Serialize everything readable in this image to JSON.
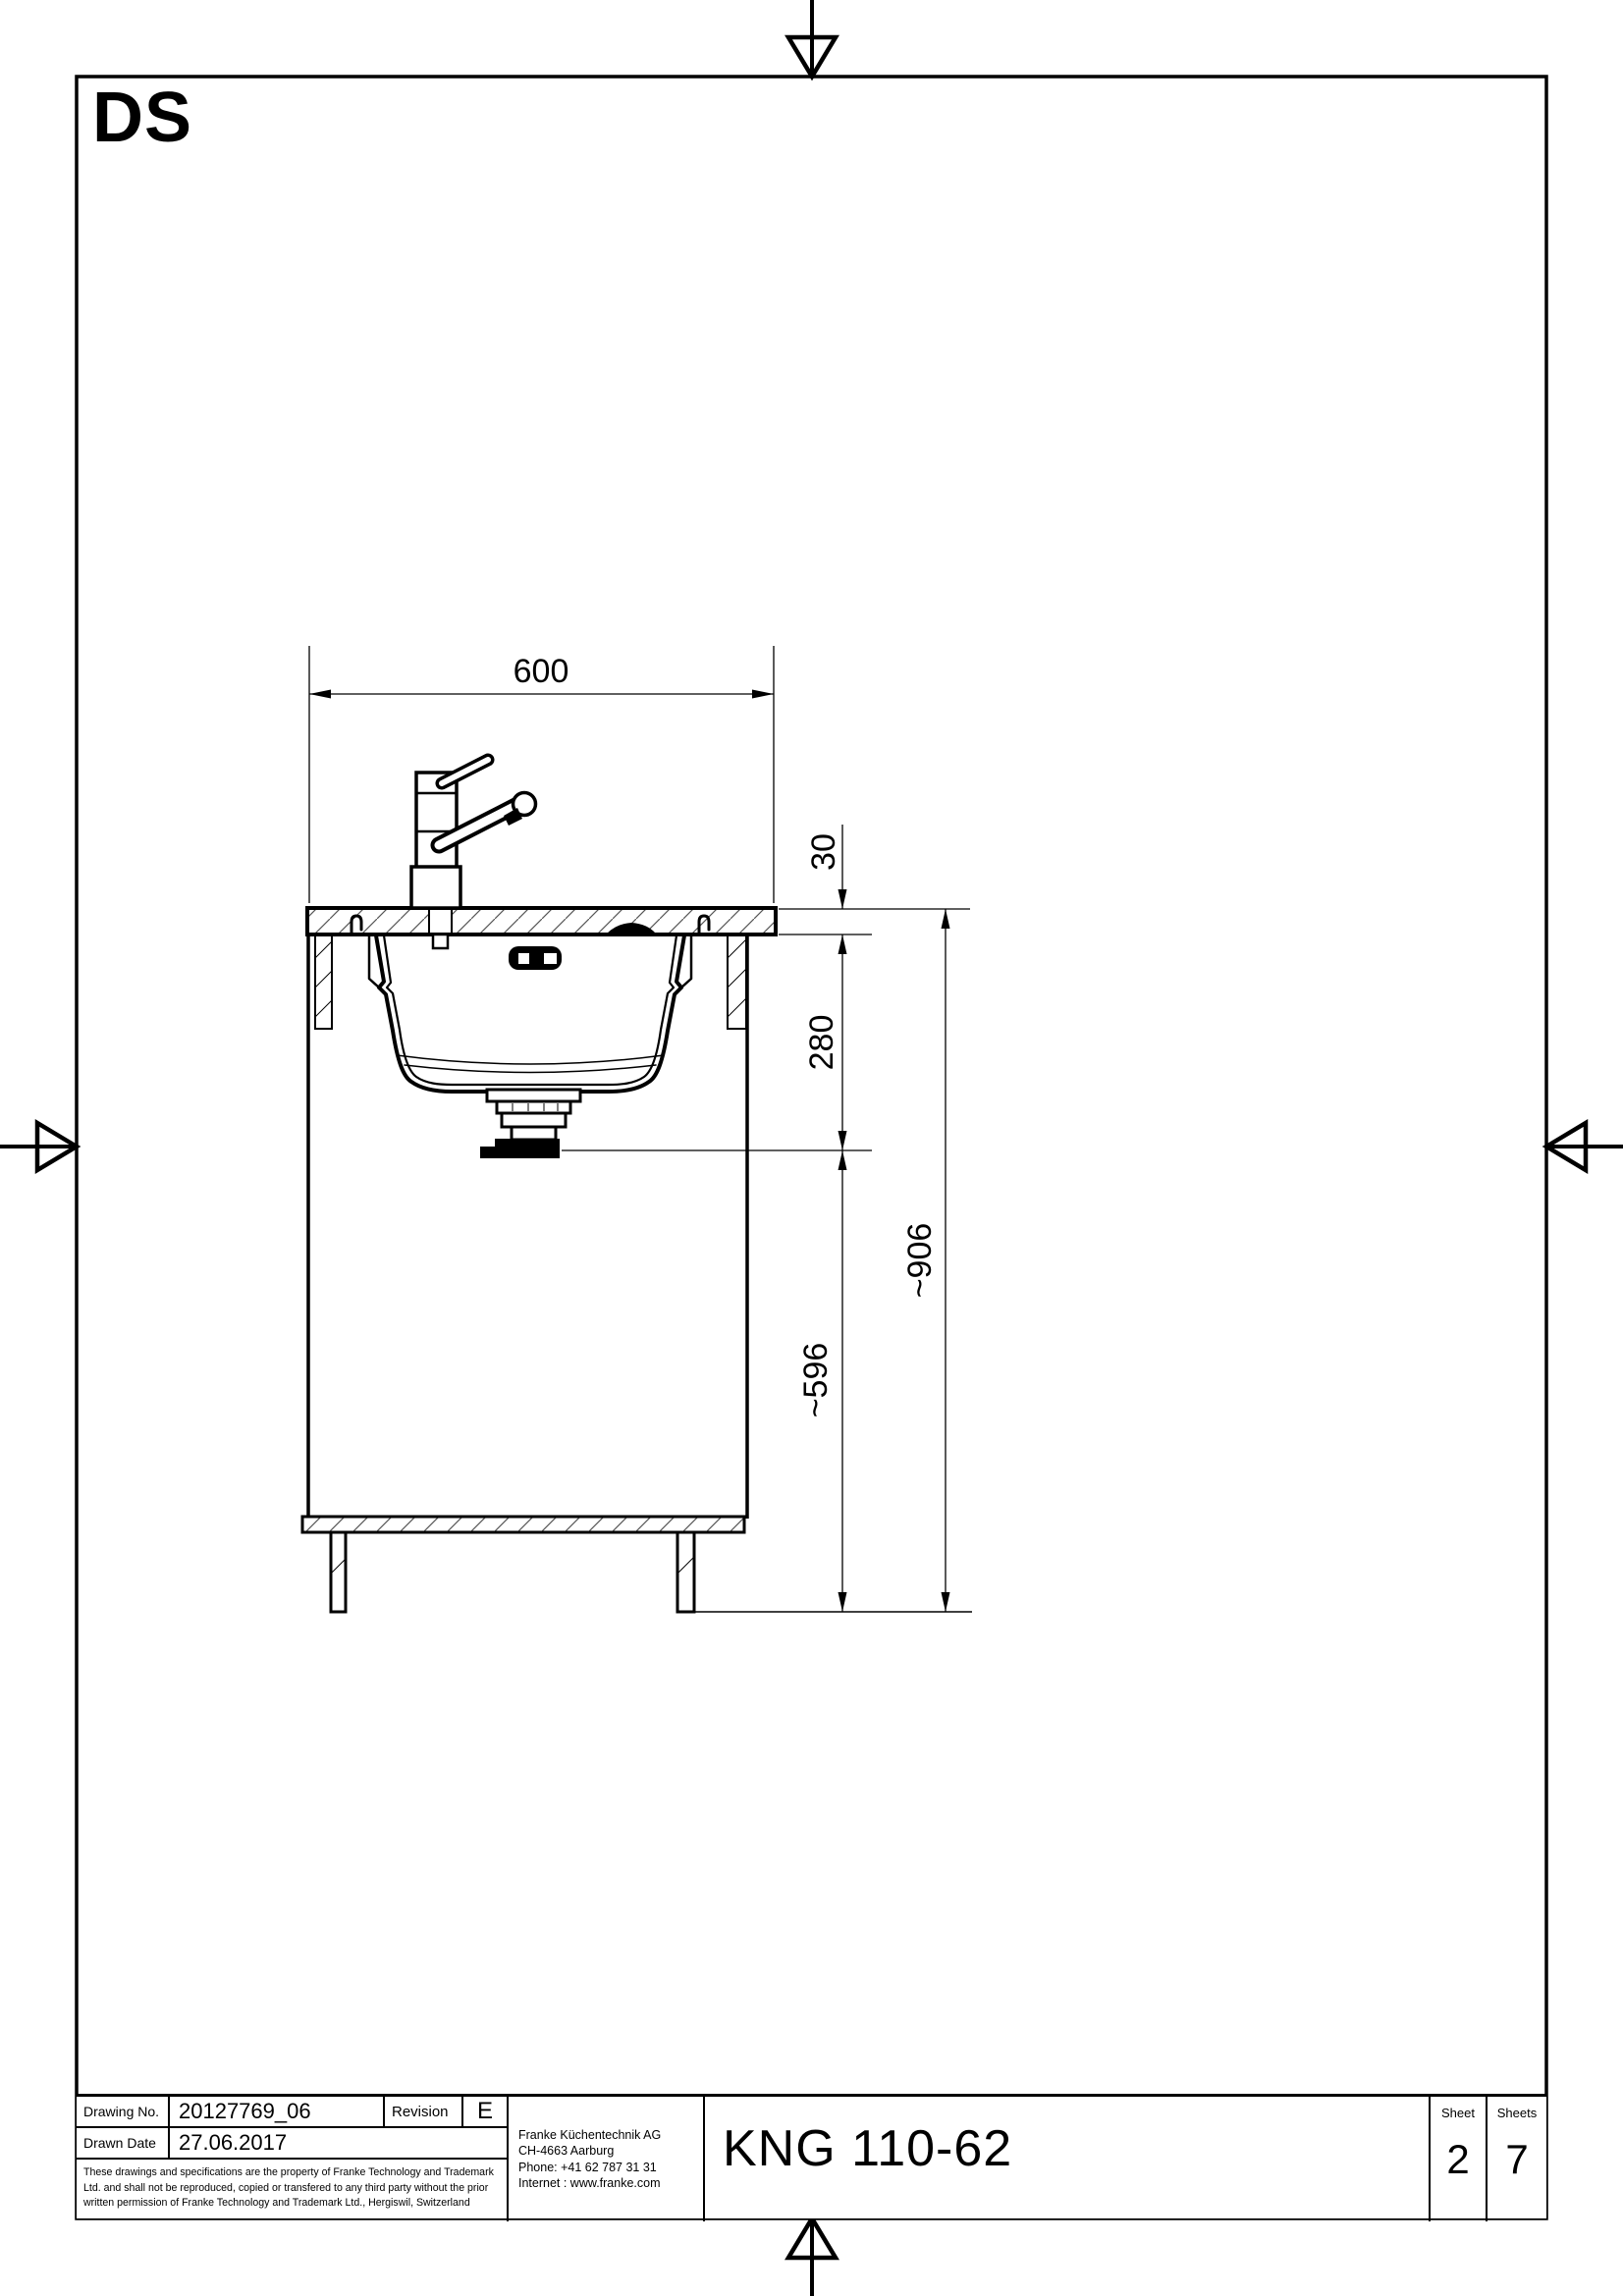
{
  "sheet": {
    "zone_label": "DS"
  },
  "drawing": {
    "dimensions": {
      "cabinet_width": "600",
      "worktop_thickness": "30",
      "bowl_depth": "280",
      "under_worktop_height": "~596",
      "total_height": "~906"
    }
  },
  "title_block": {
    "drawing_no_label": "Drawing No.",
    "drawing_no": "20127769_06",
    "revision_label": "Revision",
    "revision": "E",
    "drawn_date_label": "Drawn Date",
    "drawn_date": "27.06.2017",
    "legal_lines": [
      "These drawings and specifications are the property of Franke Technology and Trademark",
      "Ltd. and shall not be reproduced, copied or transfered to any third party without the prior",
      "written permission of Franke Technology and Trademark Ltd., Hergiswil, Switzerland"
    ],
    "company": {
      "name": "Franke Küchentechnik AG",
      "city": "CH-4663 Aarburg",
      "phone": "Phone:  +41 62 787 31 31",
      "internet": "Internet :  www.franke.com"
    },
    "product": "KNG 110-62",
    "sheet_label": "Sheet",
    "sheet_no": "2",
    "sheets_label": "Sheets",
    "sheets_total": "7"
  }
}
